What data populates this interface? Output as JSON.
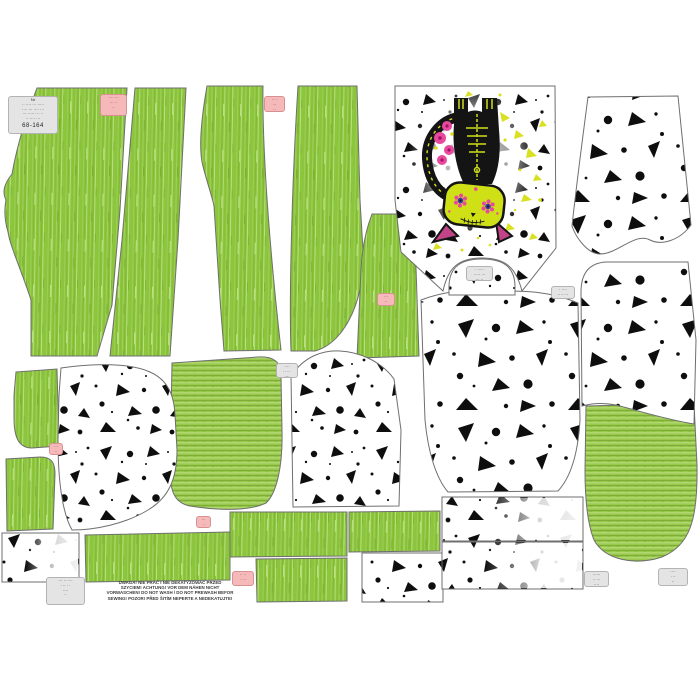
{
  "panel": {
    "description": "printed sewing pattern fabric panel preview",
    "fabrics": [
      "green melange jersey",
      "white with black splatter print",
      "green rib knit"
    ],
    "colors": {
      "green_melange": "#8cc43c",
      "green_rib": "#9ac84d",
      "splatter_black": "#0e0e0e",
      "chartreuse_splatter": "#d9e021",
      "cat_black": "#141414",
      "cat_bone_green": "#cfe017",
      "flower_pink": "#e8489d",
      "ear_pink": "#c24488",
      "label_pink_bg": "#f6b9ba",
      "label_gray_bg": "#e4e4e4",
      "piece_outline": "#6f6f6f"
    },
    "pieces": [
      {
        "name": "pants-front-left",
        "fabric": "green-melange"
      },
      {
        "name": "pants-front-right",
        "fabric": "green-melange"
      },
      {
        "name": "pants-back-left",
        "fabric": "green-melange"
      },
      {
        "name": "pants-back-right",
        "fabric": "green-melange"
      },
      {
        "name": "small-leg-piece",
        "fabric": "green-melange"
      },
      {
        "name": "side-piece-upper",
        "fabric": "green-melange"
      },
      {
        "name": "side-piece-lower",
        "fabric": "green-melange"
      },
      {
        "name": "rib-panel-left",
        "fabric": "green-rib"
      },
      {
        "name": "rib-pocket-right",
        "fabric": "green-rib"
      },
      {
        "name": "cuff-strips",
        "fabric": "green-melange"
      },
      {
        "name": "front-bodice-cat-panel",
        "fabric": "splatter-white"
      },
      {
        "name": "back-bodice",
        "fabric": "splatter-white"
      },
      {
        "name": "sleeves",
        "fabric": "splatter-white"
      },
      {
        "name": "hood",
        "fabric": "splatter-white"
      },
      {
        "name": "neck-facing-dome",
        "fabric": "splatter-white"
      },
      {
        "name": "band-rectangles",
        "fabric": "splatter-white"
      }
    ],
    "graphic": {
      "name": "sugar-skull-skeleton-cat",
      "orientation": "upside-down"
    }
  },
  "warning": {
    "lines": [
      "UWAGA! NIE PRAĆ I NIE DEKATYZOWAĆ PRZED",
      "SZYCIEM! ACHTUNG! VOR DEM NÄHEN NICHT",
      "VORWASCHEN! DO NOT WASH / DO NOT PREWASH  BEFOR",
      "SEWING! POZOR! PŘED ŠITÍM NEPERTE A  NEDEKATUJTE!"
    ]
  },
  "labels": {
    "l1": {
      "lines": [
        "Nr",
        "·· ···· ··· ·····",
        "···· ··· ···· ···",
        "··· ······ ·· ··",
        "·· ···· ···"
      ],
      "size": "68-164"
    },
    "l2": {
      "lines": [
        "····",
        "·· ···",
        "····"
      ]
    },
    "l3": {
      "lines": [
        "· ·····",
        "····· ···",
        "··· ··"
      ]
    },
    "l4": {
      "lines": [
        "· ····",
        "···· ···",
        "··· ··"
      ]
    },
    "l5": {
      "lines": [
        "······",
        "·· ···",
        "····"
      ]
    },
    "l6": {
      "lines": [
        "····",
        "· ··",
        "··",
        "·"
      ]
    },
    "l7": {
      "lines": [
        "··· ·· ····",
        "· ·· · ·",
        "····",
        "··"
      ]
    },
    "p1": {
      "lines": [
        "···· ···",
        "··· ··",
        "··"
      ]
    },
    "p2": {
      "lines": [
        "·· ·",
        "···",
        "··"
      ]
    },
    "p3": {
      "lines": [
        "···",
        "··"
      ]
    },
    "p4": {
      "lines": [
        "···",
        "··"
      ]
    },
    "p5": {
      "lines": [
        "···",
        "··"
      ]
    },
    "p6": {
      "lines": [
        "·· ··",
        "· ···"
      ]
    }
  }
}
